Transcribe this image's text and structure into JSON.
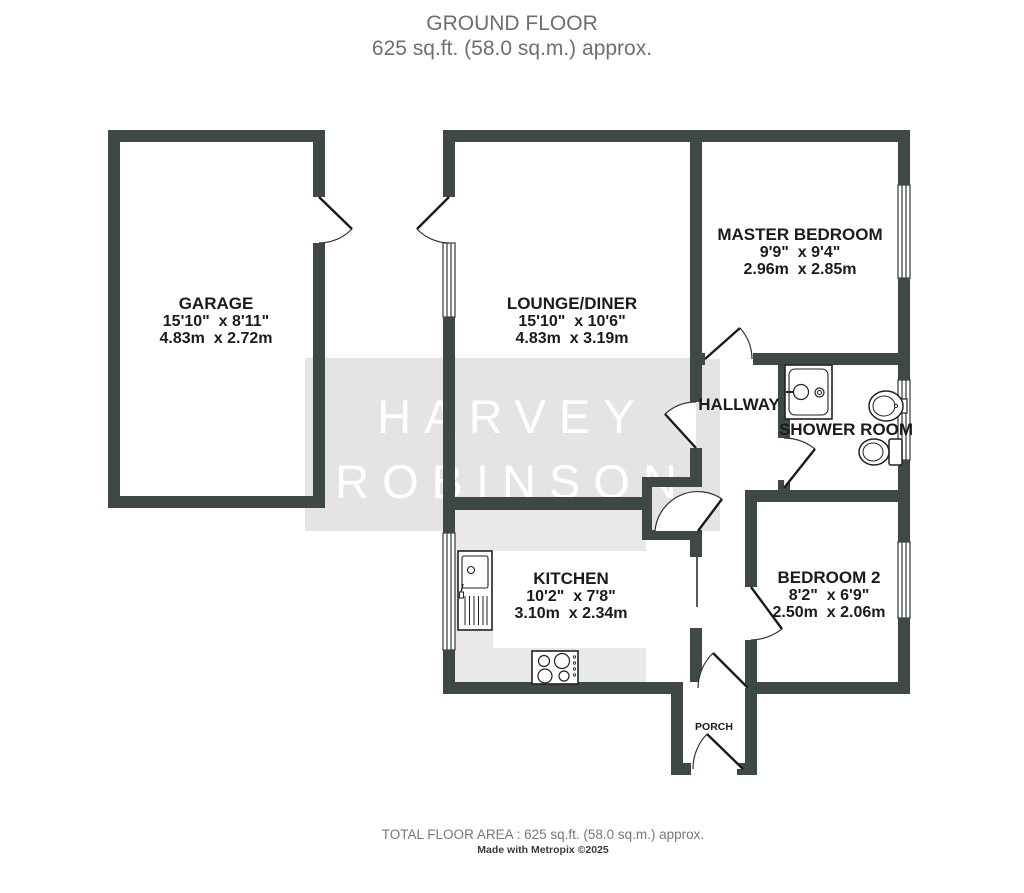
{
  "header": {
    "title": "GROUND FLOOR",
    "subtitle": "625 sq.ft. (58.0 sq.m.) approx."
  },
  "watermark": {
    "line1": "HARVEY",
    "line2": "ROBINSON"
  },
  "rooms": [
    {
      "name": "GARAGE",
      "imperial": "15'10\"  x 8'11\"",
      "metric": "4.83m  x 2.72m"
    },
    {
      "name": "LOUNGE/DINER",
      "imperial": "15'10\"  x 10'6\"",
      "metric": "4.83m  x 3.19m"
    },
    {
      "name": "MASTER BEDROOM",
      "imperial": "9'9\"  x 9'4\"",
      "metric": "2.96m  x 2.85m"
    },
    {
      "name": "HALLWAY"
    },
    {
      "name": "SHOWER ROOM"
    },
    {
      "name": "KITCHEN",
      "imperial": "10'2\"  x 7'8\"",
      "metric": "3.10m  x 2.34m"
    },
    {
      "name": "BEDROOM 2",
      "imperial": "8'2\"  x 6'9\"",
      "metric": "2.50m  x 2.06m"
    },
    {
      "name": "PORCH"
    }
  ],
  "fixtures": [
    "kitchen-sink",
    "hob",
    "shower-cubicle",
    "wash-basin",
    "toilet"
  ],
  "footer": {
    "total_area": "TOTAL FLOOR AREA : 625 sq.ft. (58.0 sq.m.) approx.",
    "credit": "Made with Metropix ©2025"
  },
  "colors": {
    "wall": "#3e4946",
    "watermark_bg": "#e4e4e4",
    "counter": "#e9e9e9",
    "label": "#1b1b1b",
    "muted_text": "#6e6e6e"
  }
}
